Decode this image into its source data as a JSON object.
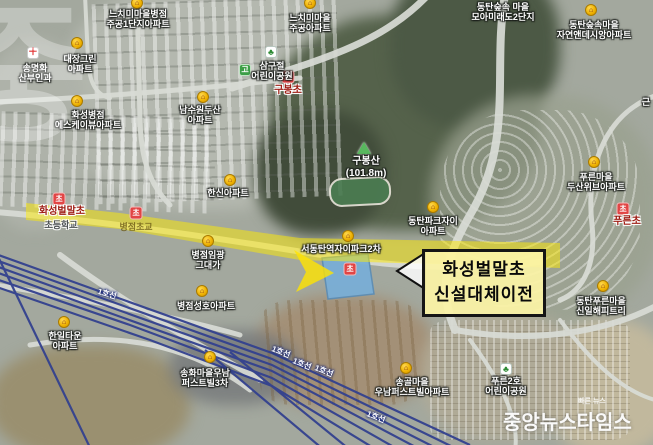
{
  "callout": {
    "line1": "화성벌말초",
    "line2": "신설대체이전"
  },
  "watermark": {
    "main": "중앙뉴스타임스",
    "tagline": "빠른 뉴스",
    "corner": "중"
  },
  "colors": {
    "highlight_yellow": "#ffe400",
    "railway_blue": "#33418f",
    "school_marker_red": "#e14545",
    "apartment_marker_yellow": "#edb000",
    "school_site_blue": "#79aed6",
    "callout_bg": "#fbf3a6"
  },
  "map": {
    "line1_label": "1호선",
    "marker_glyphs": {
      "apt": "⌂",
      "school": "초",
      "hospital": "＋",
      "park": "♣",
      "go": "고",
      "peak": ""
    },
    "markers": [
      {
        "kind": "apt",
        "x": 137,
        "y": 3
      },
      {
        "kind": "apt",
        "x": 77,
        "y": 43
      },
      {
        "kind": "hospital",
        "x": 33,
        "y": 53
      },
      {
        "kind": "apt",
        "x": 310,
        "y": 3
      },
      {
        "kind": "apt",
        "x": 591,
        "y": 10
      },
      {
        "kind": "apt",
        "x": 203,
        "y": 97
      },
      {
        "kind": "apt",
        "x": 77,
        "y": 101
      },
      {
        "kind": "apt",
        "x": 230,
        "y": 180
      },
      {
        "kind": "apt",
        "x": 594,
        "y": 162
      },
      {
        "kind": "apt",
        "x": 433,
        "y": 207
      },
      {
        "kind": "apt",
        "x": 348,
        "y": 236
      },
      {
        "kind": "apt",
        "x": 208,
        "y": 241
      },
      {
        "kind": "apt",
        "x": 64,
        "y": 322
      },
      {
        "kind": "apt",
        "x": 202,
        "y": 291
      },
      {
        "kind": "apt",
        "x": 210,
        "y": 357
      },
      {
        "kind": "apt",
        "x": 406,
        "y": 368
      },
      {
        "kind": "apt",
        "x": 603,
        "y": 286
      },
      {
        "kind": "park",
        "x": 271,
        "y": 52
      },
      {
        "kind": "go",
        "x": 245,
        "y": 70
      },
      {
        "kind": "park",
        "x": 506,
        "y": 369
      },
      {
        "kind": "school",
        "x": 59,
        "y": 199
      },
      {
        "kind": "school",
        "x": 288,
        "y": 77
      },
      {
        "kind": "school",
        "x": 623,
        "y": 209
      },
      {
        "kind": "school",
        "x": 136,
        "y": 213
      },
      {
        "kind": "school",
        "x": 350,
        "y": 269
      },
      {
        "kind": "peak",
        "x": 364,
        "y": 148
      }
    ],
    "labels": [
      {
        "name": "nchimi-byeongjeom-jugong1",
        "cls": "apt",
        "x": 138,
        "y": 9,
        "lines": [
          "느치미마을병점",
          "주공1단지아파트"
        ]
      },
      {
        "name": "daejang-green",
        "cls": "apt",
        "x": 80,
        "y": 54,
        "lines": [
          "대장그린",
          "아파트"
        ]
      },
      {
        "name": "songmyeonghwa-clinic",
        "cls": "apt",
        "x": 35,
        "y": 63,
        "lines": [
          "송명화",
          "산부인과"
        ]
      },
      {
        "name": "nchimi-jugong",
        "cls": "apt",
        "x": 310,
        "y": 13,
        "lines": [
          "느치미마을",
          "주공아파트"
        ]
      },
      {
        "name": "dongtan-forest-moamiraedo",
        "cls": "apt",
        "x": 503,
        "y": 2,
        "lines": [
          "동탄숲속 마을",
          "모아미래도2단지"
        ]
      },
      {
        "name": "dongtan-forest-desian",
        "cls": "apt",
        "x": 594,
        "y": 20,
        "lines": [
          "동탄숲속마을",
          "자연앤데시앙아파트"
        ]
      },
      {
        "name": "namsuwon-doosan",
        "cls": "apt",
        "x": 200,
        "y": 105,
        "lines": [
          "남수원두산",
          "아파트"
        ]
      },
      {
        "name": "hwaseong-skview",
        "cls": "apt",
        "x": 88,
        "y": 110,
        "lines": [
          "화성병점",
          "에스케이뷰아파트"
        ]
      },
      {
        "name": "hanshin-apt",
        "cls": "apt",
        "x": 228,
        "y": 188,
        "lines": [
          "한신아파트"
        ]
      },
      {
        "name": "dongtan-parkxi",
        "cls": "apt",
        "x": 433,
        "y": 216,
        "lines": [
          "동탄파크자이",
          "아파트"
        ]
      },
      {
        "name": "pureun-doosan-weve",
        "cls": "apt",
        "x": 596,
        "y": 172,
        "lines": [
          "푸른마을",
          "두산위브아파트"
        ]
      },
      {
        "name": "seodongtan-xi-park2",
        "cls": "apt",
        "x": 341,
        "y": 244,
        "lines": [
          "서동탄역자이파크2차"
        ]
      },
      {
        "name": "byeongjeom-imgwang-geudaega",
        "cls": "apt",
        "x": 208,
        "y": 250,
        "lines": [
          "병점임광",
          "그대가"
        ]
      },
      {
        "name": "hanil-town",
        "cls": "apt",
        "x": 65,
        "y": 331,
        "lines": [
          "한일타운",
          "아파트"
        ]
      },
      {
        "name": "byeongjeom-seongho",
        "cls": "apt",
        "x": 206,
        "y": 301,
        "lines": [
          "병점성호아파트"
        ]
      },
      {
        "name": "songhwa-woonam-firstvill3",
        "cls": "apt",
        "x": 205,
        "y": 368,
        "lines": [
          "송화마을우남",
          "퍼스트빌3차"
        ]
      },
      {
        "name": "songgol-woonam-firstvill",
        "cls": "apt",
        "x": 412,
        "y": 377,
        "lines": [
          "송골마을",
          "우남퍼스트빌아파트"
        ]
      },
      {
        "name": "dongtan-pureun-shinil",
        "cls": "apt",
        "x": 601,
        "y": 296,
        "lines": [
          "동탄푸른마을",
          "신일해피트리"
        ]
      },
      {
        "name": "samgujeol-childrens-park",
        "cls": "apt",
        "x": 272,
        "y": 61,
        "lines": [
          "삼구절",
          "어린이공원"
        ]
      },
      {
        "name": "pureun2-childrens-park",
        "cls": "apt",
        "x": 506,
        "y": 376,
        "lines": [
          "푸른2호",
          "어린이공원"
        ]
      },
      {
        "name": "geunrin-fragment",
        "cls": "apt",
        "x": 646,
        "y": 97,
        "lines": [
          "근"
        ]
      },
      {
        "name": "gubong-elementary",
        "cls": "school",
        "x": 288,
        "y": 85,
        "lines": [
          "구봉초"
        ]
      },
      {
        "name": "hwaseong-beolmal-elementary",
        "cls": "school",
        "x": 62,
        "y": 206,
        "lines": [
          "화성벌말초"
        ]
      },
      {
        "name": "beolmal-sub-label",
        "cls": "gray",
        "x": 61,
        "y": 220,
        "lines": [
          "초등학교"
        ]
      },
      {
        "name": "pureun-elementary",
        "cls": "school",
        "x": 627,
        "y": 216,
        "lines": [
          "푸른초"
        ]
      },
      {
        "name": "byeongjeom-elementary",
        "cls": "band-school",
        "x": 136,
        "y": 222,
        "under": true,
        "lines": [
          "병점초교"
        ]
      },
      {
        "name": "gubongsan-peak",
        "cls": "mtn",
        "x": 366,
        "y": 156,
        "lines": [
          "구봉산",
          "(101.8m)"
        ]
      }
    ],
    "railway_labels": [
      {
        "x": 107,
        "y": 294,
        "r": 16
      },
      {
        "x": 281,
        "y": 352,
        "r": 22
      },
      {
        "x": 302,
        "y": 364,
        "r": 22
      },
      {
        "x": 324,
        "y": 371,
        "r": 22
      },
      {
        "x": 376,
        "y": 417,
        "r": 22
      }
    ]
  }
}
